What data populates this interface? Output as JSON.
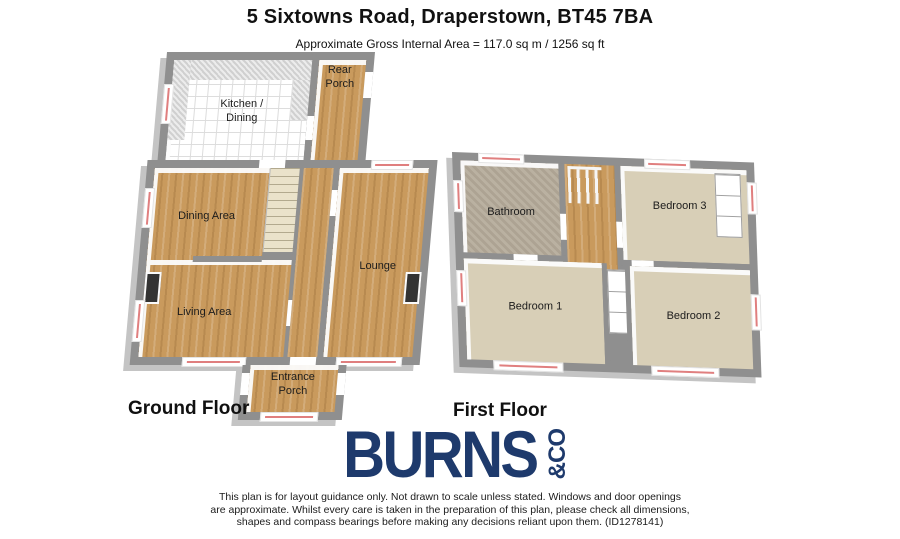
{
  "header": {
    "title": "5 Sixtowns Road, Draperstown, BT45 7BA",
    "subtitle": "Approximate Gross Internal Area = 117.0 sq m / 1256 sq ft"
  },
  "ground_floor": {
    "label": "Ground Floor",
    "rooms": {
      "kitchen": "Kitchen /\nDining",
      "rear_porch": "Rear\nPorch",
      "dining": "Dining Area",
      "living": "Living Area",
      "lounge": "Lounge",
      "entrance_porch": "Entrance\nPorch"
    }
  },
  "first_floor": {
    "label": "First Floor",
    "rooms": {
      "bathroom": "Bathroom",
      "bedroom1": "Bedroom 1",
      "bedroom2": "Bedroom 2",
      "bedroom3": "Bedroom 3"
    }
  },
  "logo": {
    "name": "BURNS",
    "suffix": "&CO"
  },
  "disclaimer": {
    "line1": "This plan is for layout guidance only. Not drawn to scale unless stated. Windows and door openings",
    "line2": "are approximate. Whilst every care is taken in the preparation of this plan, please check all dimensions,",
    "line3": "shapes and compass bearings before making any decisions reliant upon them. (ID1278141)"
  },
  "colors": {
    "wall": "#8f8f8f",
    "wall_side": "#c4c4c4",
    "wood_floor": "#c99a5d",
    "carpet": "#d8cfb7",
    "bathroom_floor": "#b6ac9b",
    "tile": "#ffffff",
    "stairs": "#eae2ca",
    "window_line": "#e07f7f",
    "logo_navy": "#1e3a6c"
  }
}
